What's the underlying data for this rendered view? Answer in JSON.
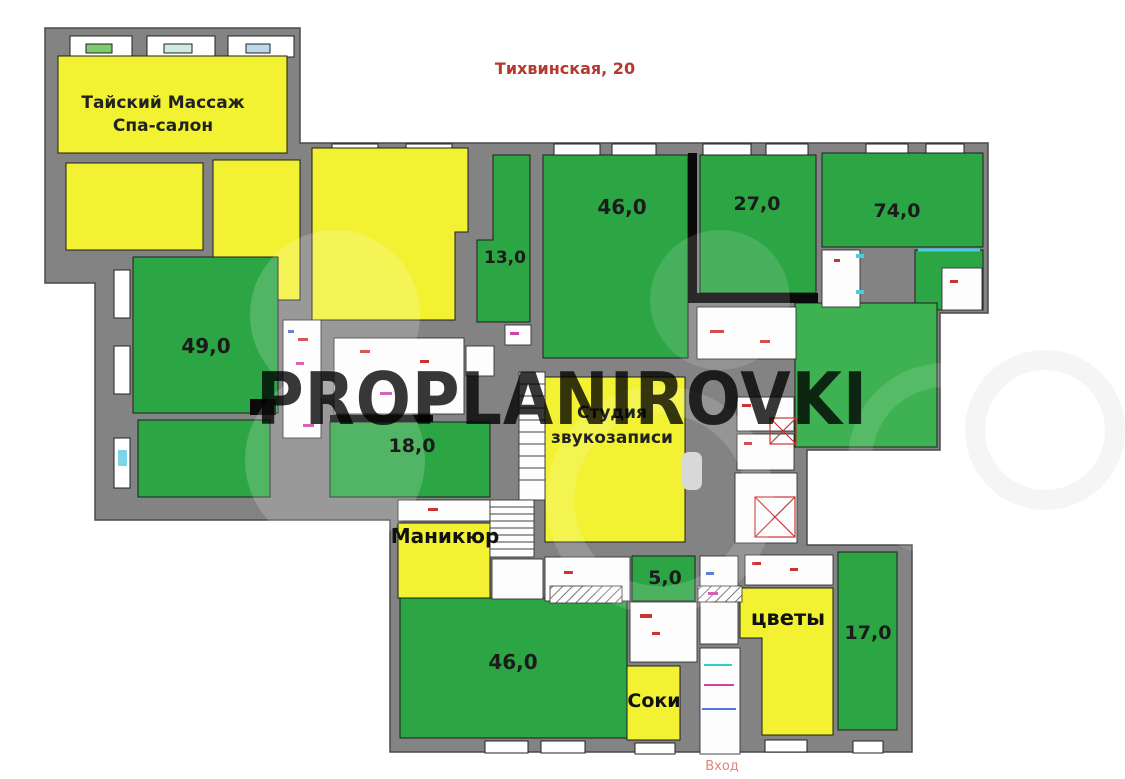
{
  "title": "Тихвинская, 20",
  "watermark": "PROPLANIROVKI",
  "entrance_label": "Вход",
  "rooms": {
    "spa": {
      "line1": "Тайский Массаж",
      "line2": "Спа-салон",
      "color": "#f2f233"
    },
    "r49": {
      "area": "49,0",
      "color": "#2ca545"
    },
    "r13": {
      "area": "13,0",
      "color": "#2ca545"
    },
    "r46_top": {
      "area": "46,0",
      "color": "#2ca545"
    },
    "r27": {
      "area": "27,0",
      "color": "#2ca545"
    },
    "r74": {
      "area": "74,0",
      "color": "#2ca545"
    },
    "r18": {
      "area": "18,0",
      "color": "#2ca545"
    },
    "studio": {
      "line1": "Студия",
      "line2": "звукозаписи",
      "color": "#f2f233"
    },
    "manicure": {
      "name": "Маникюр",
      "color": "#f2f233"
    },
    "r5": {
      "area": "5,0",
      "color": "#2ca545"
    },
    "r46_bottom": {
      "area": "46,0",
      "color": "#2ca545"
    },
    "juice": {
      "name": "Соки",
      "color": "#f2f233"
    },
    "flowers": {
      "name": "цветы",
      "color": "#f2f233"
    },
    "r17": {
      "area": "17,0",
      "color": "#2ca545"
    }
  },
  "colors": {
    "wall": "#838383",
    "green": "#2ca545",
    "green_light": "#3eb253",
    "yellow": "#f2f233",
    "title_red": "#b4392e",
    "entrance_pink": "#e08579",
    "watermark": "#3a3a3a",
    "door_cyan": "#49cde4",
    "annotation_red": "#cc3333"
  }
}
